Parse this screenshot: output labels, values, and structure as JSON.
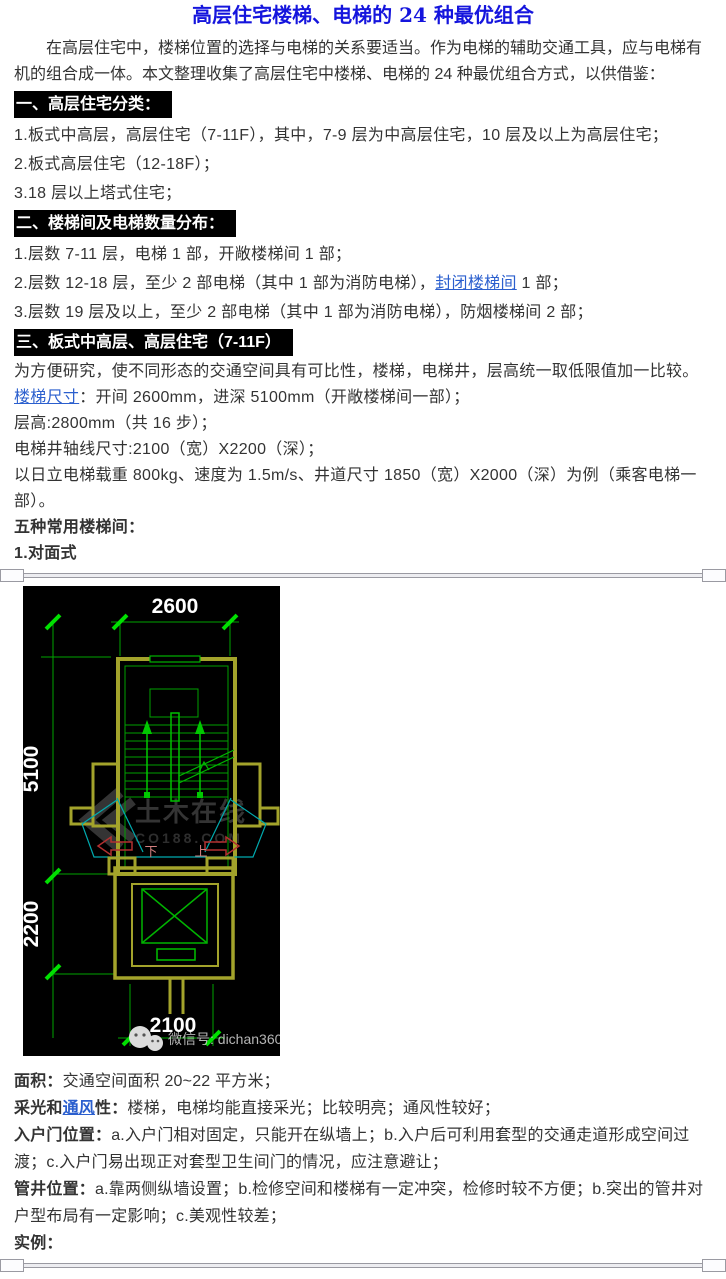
{
  "title": "高层住宅楼梯、电梯的 24 种最优组合",
  "intro": "在高层住宅中，楼梯位置的选择与电梯的关系要适当。作为电梯的辅助交通工具，应与电梯有机的组合成一体。本文整理收集了高层住宅中楼梯、电梯的 24 种最优组合方式，以供借鉴：",
  "section1": {
    "heading": "一、高层住宅分类：",
    "item1": "1.板式中高层，高层住宅（7-11F），其中，7-9 层为中高层住宅，10 层及以上为高层住宅；",
    "item2": "2.板式高层住宅（12-18F）；",
    "item3": "3.18 层以上塔式住宅；"
  },
  "section2": {
    "heading": "二、楼梯间及电梯数量分布：",
    "item1": "1.层数 7-11 层，电梯 1 部，开敞楼梯间 1 部；",
    "item2_pre": "2.层数 12-18 层，至少 2 部电梯（其中 1 部为消防电梯），",
    "item2_link": "封闭楼梯间",
    "item2_post": " 1 部；",
    "item3": "3.层数 19 层及以上，至少 2 部电梯（其中 1 部为消防电梯），防烟楼梯间 2 部；"
  },
  "section3": {
    "heading": "三、板式中高层、高层住宅（7-11F）",
    "p1": "为方便研究，使不同形态的交通空间具有可比性，楼梯，电梯井，层高统一取低限值加一比较。",
    "p2_link": "楼梯尺寸",
    "p2_post": "：开间 2600mm，进深 5100mm（开敞楼梯间一部）；",
    "p3": "层高:2800mm（共 16 步）；",
    "p4": "电梯井轴线尺寸:2100（宽）X2200（深）；",
    "p5": "以日立电梯载重 800kg、速度为 1.5m/s、井道尺寸 1850（宽）X2000（深）为例（乘客电梯一部）。",
    "p6": "五种常用楼梯间：",
    "p7": "1.对面式"
  },
  "cad": {
    "dim_width_top": "2600",
    "dim_depth_stair": "5100",
    "dim_depth_elevator": "2200",
    "dim_width_bottom": "2100",
    "label_down": "下",
    "label_up": "上",
    "watermark_site": "土木在线",
    "watermark_domain": "CO188.COM",
    "watermark_wechat": "微信号: dichan360",
    "colors": {
      "background": "#000000",
      "wall": "#a3a32b",
      "line_green": "#00a400",
      "tick_green": "#00e000",
      "door_cyan": "#00aaae",
      "arrow_red": "#b23030",
      "stair_label": "#d27f7f",
      "dim_text": "#ffffff",
      "watermark_gray": "#3a3a3a"
    }
  },
  "notes": {
    "n1_label": "面积：",
    "n1_text": "交通空间面积 20~22 平方米；",
    "n2_label_pre": "采光和",
    "n2_link": "通风",
    "n2_label_post": "性：",
    "n2_text": "楼梯，电梯均能直接采光；比较明亮；通风性较好；",
    "n3_label": "入户门位置：",
    "n3_text": "a.入户门相对固定，只能开在纵墙上；b.入户后可利用套型的交通走道形成空间过渡；c.入户门易出现正对套型卫生间门的情况，应注意避让；",
    "n4_label": "管井位置：",
    "n4_text": "a.靠两侧纵墙设置；b.检修空间和楼梯有一定冲突，检修时较不方便；b.突出的管井对户型布局有一定影响；c.美观性较差；",
    "n5_label": "实例："
  },
  "ui_colors": {
    "title_blue": "#1515dd",
    "link_blue": "#2b5fce",
    "header_bg": "#000000",
    "header_fg": "#ffffff",
    "body_text": "#333333"
  }
}
